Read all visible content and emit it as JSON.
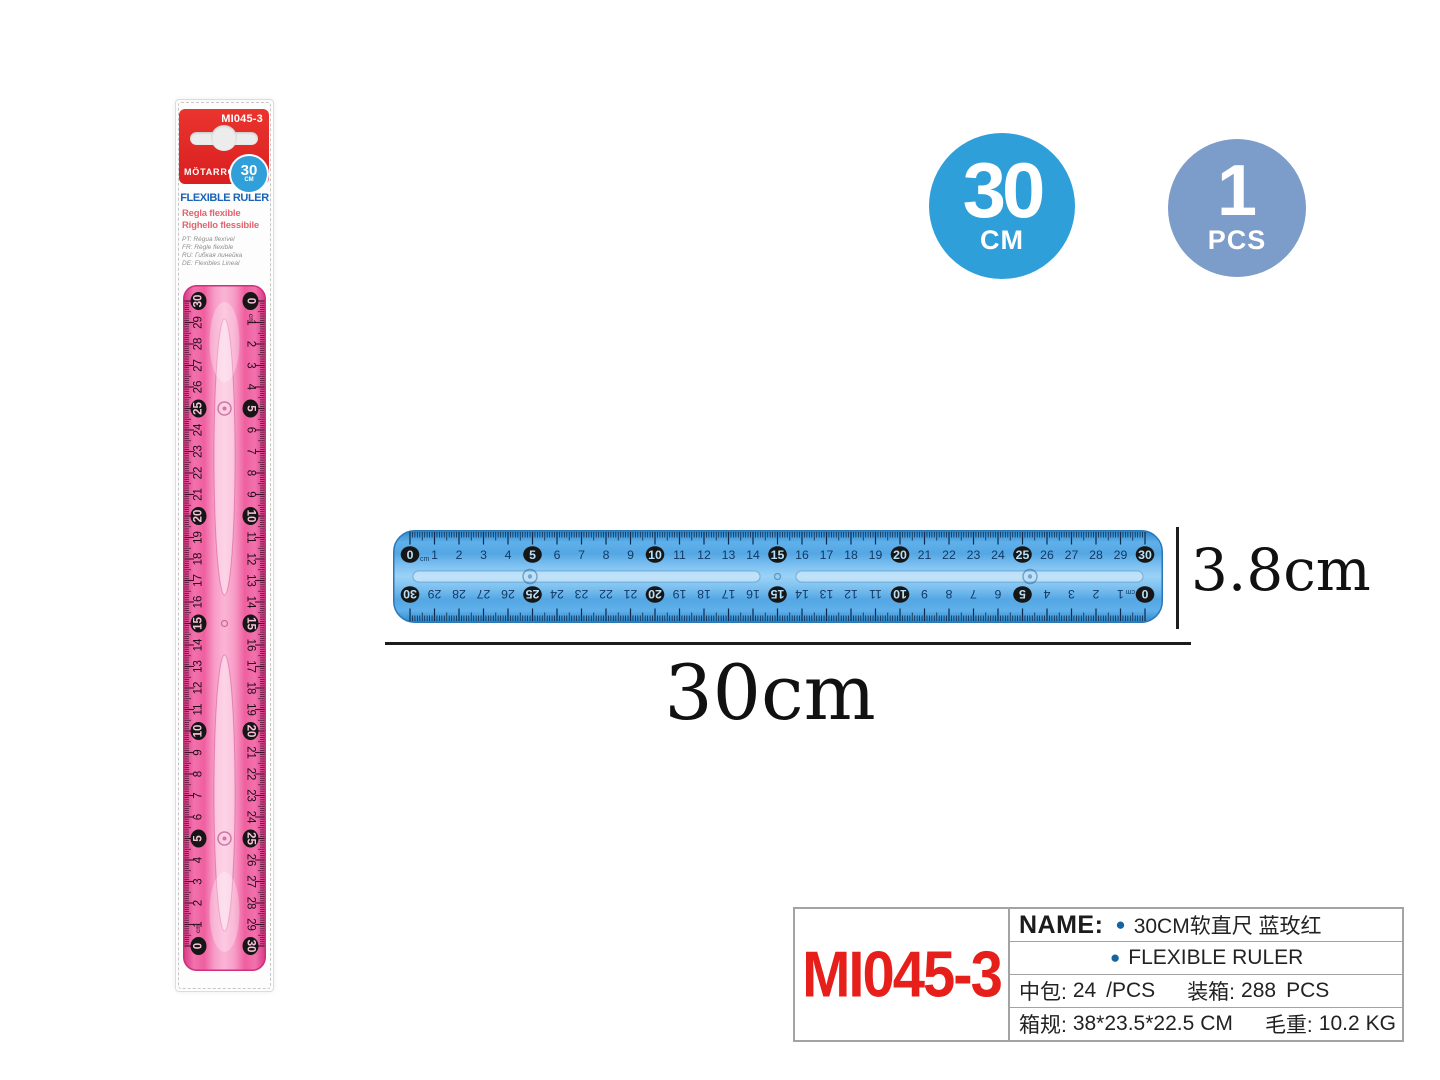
{
  "package": {
    "code": "MI045-3",
    "brand": "MÖTARRO®",
    "badge_value": "30",
    "badge_unit": "CM",
    "title": "FLEXIBLE RULER",
    "subtitle_es": "Regla flexible",
    "subtitle_it": "Righello flessibile",
    "languages": [
      "PT: Régua flexível",
      "FR: Règle flexible",
      "RU: Гибкая линейка",
      "DE: Flexibles Lineal"
    ]
  },
  "badges": {
    "size": {
      "value": "30",
      "unit": "CM"
    },
    "qty": {
      "value": "1",
      "unit": "PCS"
    }
  },
  "dimensions": {
    "length_label": "30cm",
    "width_label": "3.8cm"
  },
  "info_table": {
    "model": "MI045-3",
    "name_label": "NAME:",
    "bullet": "●",
    "name_cn": "30CM软直尺 蓝玫红",
    "name_en": "FLEXIBLE RULER",
    "pack_label": "中包:",
    "pack_value": "24",
    "pack_unit": "/PCS",
    "carton_label": "装箱:",
    "carton_value": "288",
    "carton_unit": "PCS",
    "carton_size_label": "箱规:",
    "carton_size_value": "38*23.5*22.5",
    "carton_size_unit": "CM",
    "weight_label": "毛重:",
    "weight_value": "10.2",
    "weight_unit": "KG"
  },
  "rulers": {
    "unit_label": "cm",
    "max_cm": 30,
    "circled_interval": 5,
    "numbers": [
      0,
      1,
      2,
      3,
      4,
      5,
      6,
      7,
      8,
      9,
      10,
      11,
      12,
      13,
      14,
      15,
      16,
      17,
      18,
      19,
      20,
      21,
      22,
      23,
      24,
      25,
      26,
      27,
      28,
      29,
      30
    ],
    "blue": {
      "edge": "#2878b8",
      "tick": "#0c2a4d",
      "num": "#123a66",
      "circle_fill": "#161616",
      "circle_num": "#b8e0f8",
      "grad": [
        "#2e86c8",
        "#5fb0ea",
        "#54a7e4",
        "#7cc0f0",
        "#9bd2f6",
        "#7cc0f0",
        "#54a7e4",
        "#5fb0ea",
        "#2e86c8"
      ]
    },
    "pink": {
      "edge": "#cf2f7d",
      "tick": "#42102a",
      "num": "#200a16",
      "circle_fill": "#161616",
      "circle_num": "#f8c3da",
      "grad": [
        "#d63b85",
        "#f272ae",
        "#ef5f9f",
        "#f79cc6",
        "#fbb5d6",
        "#f79cc6",
        "#ef5f9f",
        "#f272ae",
        "#d63b85"
      ]
    }
  }
}
